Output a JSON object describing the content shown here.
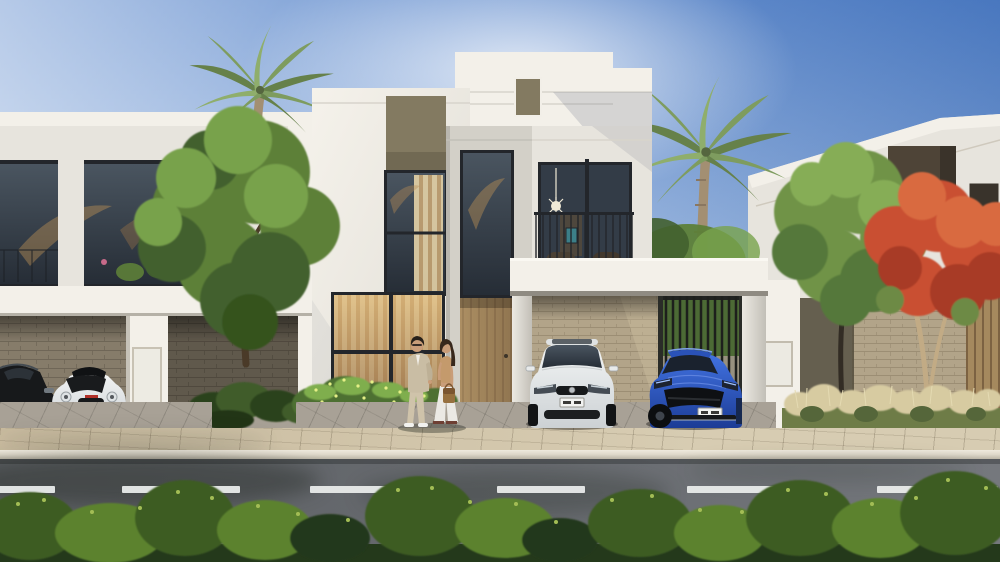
{
  "scene": {
    "description": "Sunny photorealistic architectural rendering of three modern flat-roofed white villas along a street; the center villa has a carport with a white hatchback and a blue coupe, a couple stands talking by the entrance, palm trees and a red flame tree frame the homes, with a paved sidewalk, asphalt road with dashed lane line, and a low hedge in the foreground.",
    "setting": "daytime, clear blue sky, sunlight from upper left",
    "style": "photorealistic 3D exterior render"
  },
  "counts": {
    "villas": 3,
    "cars": 4,
    "people": 2,
    "palm_trees": 2,
    "lane_dashes": 6
  },
  "license_plates": {
    "visible": true,
    "legible": false,
    "style": "white rectangle with dark characters"
  },
  "colors": {
    "sky_top": "#5d89cc",
    "sky_mid": "#9ab7e0",
    "sky_low": "#dde6f1",
    "white_sun": "#f3f0e9",
    "white_base": "#e7e4dd",
    "white_shade": "#cfccc4",
    "grey_recess": "#d3d0c8",
    "olive_panel": "#837a61",
    "frame_dark": "#23262b",
    "glass_dark": "#39424e",
    "glass_deep": "#2a313b",
    "warm_light": "#e0b877",
    "warm_deep": "#8a5c33",
    "wood": "#a5895e",
    "wood_dark": "#7c6242",
    "brick": "#b2a489",
    "brick_line": "#9c8e74",
    "stone": "#867c6a",
    "stone_line": "#6f6657",
    "foliage_bg": "#4c6a35",
    "fence_dark": "#202220",
    "apron": "#a8a196",
    "walk": "#c9bb9f",
    "walk_light": "#d7ccb2",
    "curb": "#ded8ca",
    "road": "#5d6064",
    "road_light": "#75787d",
    "hedge_dark": "#24391b",
    "hedge_mid": "#3c5c24",
    "hedge_light": "#5c822e",
    "hedge_tip": "#a3bd55",
    "leaf_dark": "#42612f",
    "leaf_mid": "#5d8038",
    "leaf_light": "#78a24c",
    "palm_mid": "#7e9c5f",
    "palm_dark": "#66814a",
    "palm_light": "#8fae6c",
    "palm_trunk": "#a38f72",
    "flame_mid": "#c94f32",
    "flame_dark": "#a83b26",
    "flame_light": "#d96a41",
    "flame_trunk": "#c2ab85",
    "trunk_dark": "#4a3a28",
    "trunk_deep": "#322c24",
    "car_white": "#eceeee",
    "car_blue": "#2e5ece",
    "car_blue_deep": "#1c3c96",
    "car_black": "#17191b",
    "plate": "#f2f3f1",
    "skin": "#c99d79",
    "hair_dark": "#27201a",
    "suit": "#c9bda4",
    "top_tan": "#c49a6c",
    "cloth_white": "#ebe9e4",
    "bag_tan": "#96703f",
    "teal": "#3c7f88",
    "orange": "#c9703e",
    "table_red": "#b14534",
    "grass_pale": "#d7cba1",
    "grass_green": "#6e7c47"
  }
}
